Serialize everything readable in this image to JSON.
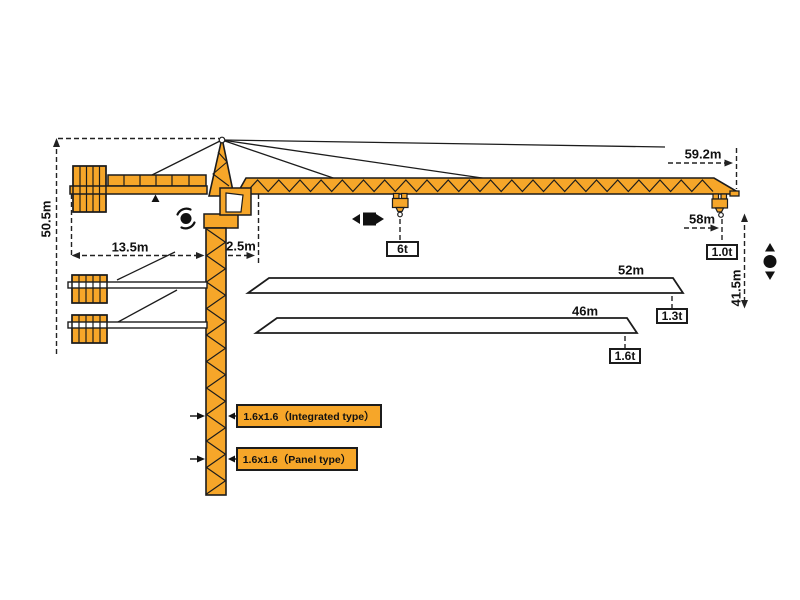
{
  "dims": {
    "tower_height": "50.5m",
    "counter_jib": "13.5m",
    "mast_to_pivot": "2.5m",
    "jib_length_max": "59.2m",
    "hook_radius_max": "58m",
    "hook_height": "41.5m"
  },
  "loads": {
    "mid_jib": "6t",
    "tip_at_59m": "1.0t",
    "tip_at_52m": "1.3t",
    "tip_at_46m": "1.6t"
  },
  "jib_options": {
    "jib_52": "52m",
    "jib_46": "46m"
  },
  "mast": {
    "integrated": "1.6x1.6（Integrated type）",
    "panel": "1.6x1.6（Panel type）"
  },
  "colors": {
    "crane": "#F6A629",
    "outline": "#1c1c1c",
    "dim_line": "#222222"
  },
  "icons": {
    "slewing_icon": "rotation-arrows-around-dot",
    "trolley_travel_icon": "left-right-arrows-square",
    "hoist_icon": "up-down-arrows-dot",
    "counter_jib_pointer_icon": "up-triangle"
  }
}
